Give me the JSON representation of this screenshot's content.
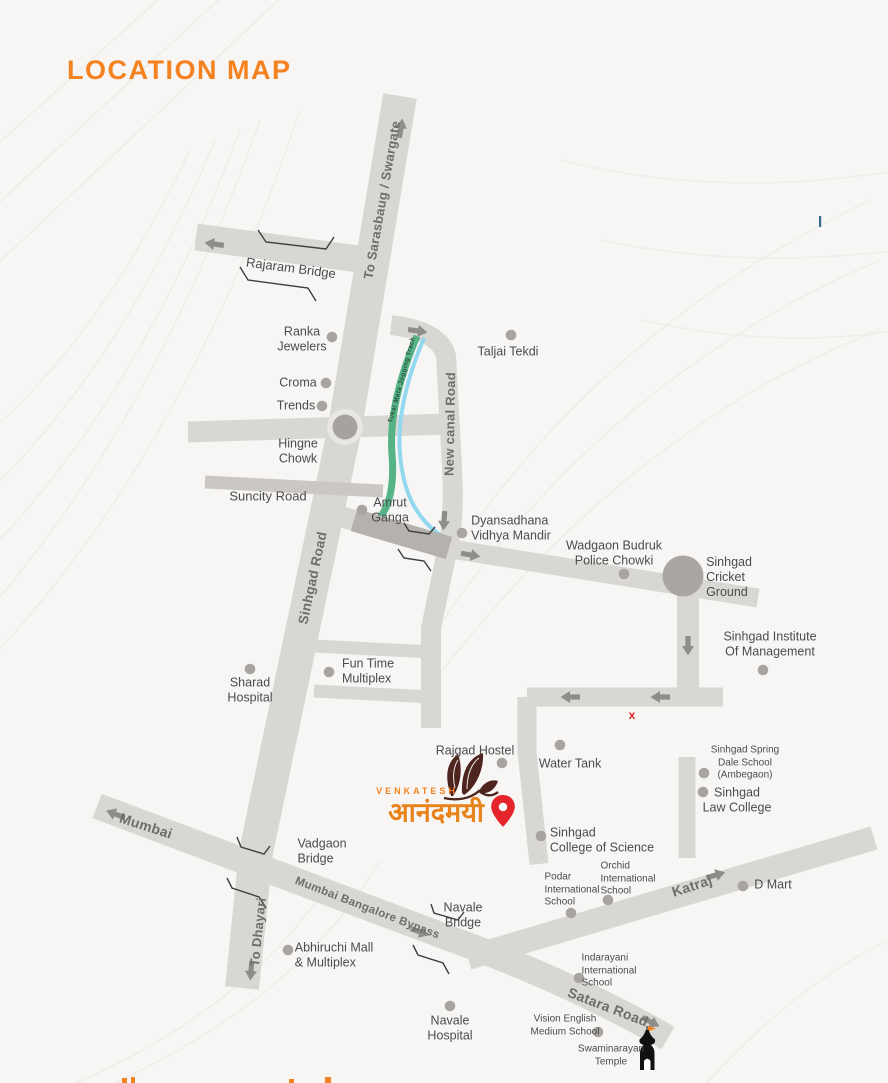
{
  "title": "LOCATION MAP",
  "logo": {
    "brand": "VENKATESH",
    "project_name": "आनंदमयी"
  },
  "roads": {
    "to_sarasbaug": "To Sarasbaug / Swargate",
    "rajaram_bridge": "Rajaram Bridge",
    "new_canal_road": "New canal Road",
    "suncity_road": "Suncity Road",
    "sinhgad_road": "Sinhgad Road",
    "jogging_track": "Tukai Mata Jogging Track",
    "mumbai": "Mumbai",
    "mumbai_bangalore_bypass": "Mumbai Bangalore Bypass",
    "to_dhayari": "To Dhayari",
    "katraj": "Katraj",
    "satara_road": "Satara Road",
    "vadgaon_bridge": "Vadgaon\nBridge",
    "navale_bridge": "Navale\nBridge"
  },
  "pois": {
    "ranka_jewelers": "Ranka\nJewelers",
    "croma": "Croma",
    "trends": "Trends",
    "hingne_chowk": "Hingne\nChowk",
    "taljai_tekdi": "Taljai Tekdi",
    "amrut_ganga": "Amrut\nGanga",
    "dyansadhana": "Dyansadhana\nVidhya Mandir",
    "wadgaon_budruk_police_chowki": "Wadgaon Budruk\nPolice Chowki",
    "sinhgad_cricket_ground": "Sinhgad\nCricket\nGround",
    "sinhgad_institute": "Sinhgad Institute\nOf Management",
    "fun_time_multiplex": "Fun Time\nMultiplex",
    "sharad_hospital": "Sharad\nHospital",
    "rajgad_hostel": "Rajgad Hostel",
    "water_tank": "Water Tank",
    "sinhgad_spring_dale": "Sinhgad Spring\nDale School\n(Ambegaon)",
    "sinhgad_law_college": "Sinhgad\nLaw College",
    "sinhgad_college_of_science": "Sinhgad\nCollege of Science",
    "podar_school": "Podar\nInternational\nSchool",
    "orchid_school": "Orchid\nInternational\nSchool",
    "d_mart": "D Mart",
    "abhiruchi_mall": "Abhiruchi Mall\n& Multiplex",
    "navale_hospital": "Navale\nHospital",
    "indarayani_school": "Indarayani\nInternational\nSchool",
    "vision_english_school": "Vision English\nMedium School",
    "swaminarayan_temple": "Swaminarayan\nTemple"
  },
  "markers": {
    "closed_x": "x"
  },
  "colors": {
    "accent_orange": "#f58220",
    "pin_red": "#e5252b",
    "track_green": "#55b386",
    "canal_blue": "#92d8ef",
    "road_gray": "#d9d7d3",
    "text_gray": "#4c4c4e"
  }
}
